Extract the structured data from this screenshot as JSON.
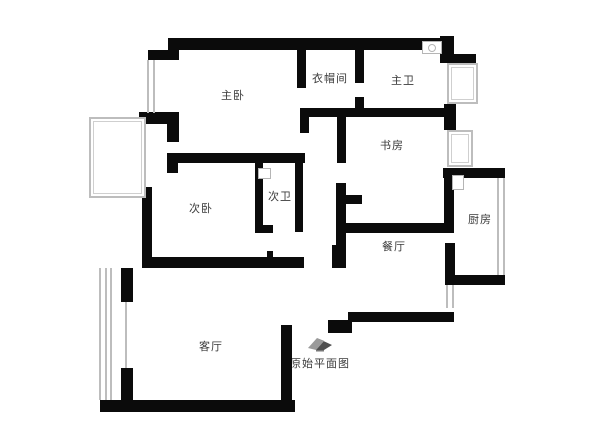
{
  "meta": {
    "caption": "原始平面图",
    "caption_icon": "house-roof-icon",
    "caption_x": 320,
    "caption_y": 336
  },
  "colors": {
    "wall": "#0b0b0b",
    "window": "#bdbdbd",
    "fixture": "#b5b5b5",
    "label": "#3a3a3a",
    "background": "#ffffff",
    "icon_dark": "#4f4f4f",
    "icon_light": "#9a9a9a"
  },
  "plan": {
    "rooms": [
      {
        "id": "master-bedroom",
        "label": "主卧",
        "x": 233,
        "y": 95
      },
      {
        "id": "closet",
        "label": "衣帽间",
        "x": 330,
        "y": 78
      },
      {
        "id": "master-bath",
        "label": "主卫",
        "x": 403,
        "y": 80
      },
      {
        "id": "study",
        "label": "书房",
        "x": 392,
        "y": 145
      },
      {
        "id": "second-bedroom",
        "label": "次卧",
        "x": 201,
        "y": 208
      },
      {
        "id": "second-bath",
        "label": "次卫",
        "x": 280,
        "y": 196
      },
      {
        "id": "dining-room",
        "label": "餐厅",
        "x": 394,
        "y": 246
      },
      {
        "id": "kitchen",
        "label": "厨房",
        "x": 480,
        "y": 219
      },
      {
        "id": "living-room",
        "label": "客厅",
        "x": 211,
        "y": 346
      }
    ],
    "walls": [
      [
        168,
        38,
        276,
        12
      ],
      [
        148,
        50,
        31,
        10
      ],
      [
        440,
        36,
        14,
        27
      ],
      [
        448,
        54,
        28,
        11
      ],
      [
        444,
        104,
        12,
        26
      ],
      [
        443,
        168,
        62,
        10
      ],
      [
        444,
        178,
        10,
        47
      ],
      [
        445,
        243,
        10,
        42
      ],
      [
        448,
        275,
        57,
        10
      ],
      [
        348,
        312,
        106,
        10
      ],
      [
        328,
        320,
        24,
        13
      ],
      [
        281,
        325,
        11,
        83
      ],
      [
        100,
        400,
        195,
        12
      ],
      [
        121,
        268,
        12,
        34
      ],
      [
        121,
        368,
        12,
        34
      ],
      [
        142,
        187,
        10,
        81
      ],
      [
        143,
        257,
        161,
        11
      ],
      [
        332,
        245,
        11,
        23
      ],
      [
        167,
        153,
        138,
        10
      ],
      [
        167,
        153,
        11,
        20
      ],
      [
        255,
        163,
        8,
        70
      ],
      [
        255,
        225,
        18,
        8
      ],
      [
        295,
        163,
        8,
        69
      ],
      [
        297,
        50,
        9,
        38
      ],
      [
        355,
        50,
        9,
        33
      ],
      [
        355,
        97,
        9,
        15
      ],
      [
        300,
        108,
        155,
        9
      ],
      [
        300,
        108,
        9,
        25
      ],
      [
        139,
        112,
        40,
        12
      ],
      [
        167,
        112,
        12,
        30
      ],
      [
        337,
        117,
        9,
        46
      ],
      [
        336,
        183,
        10,
        85
      ],
      [
        337,
        195,
        25,
        9
      ],
      [
        340,
        223,
        114,
        10
      ],
      [
        267,
        251,
        6,
        6
      ]
    ],
    "windows": [
      {
        "type": "vlines",
        "x": 147,
        "y": 60,
        "w": 8,
        "h": 53,
        "lines": 2
      },
      {
        "type": "box",
        "x": 89,
        "y": 117,
        "w": 57,
        "h": 81
      },
      {
        "type": "box",
        "x": 447,
        "y": 63,
        "w": 31,
        "h": 41
      },
      {
        "type": "box",
        "x": 447,
        "y": 130,
        "w": 26,
        "h": 37
      },
      {
        "type": "vlines",
        "x": 497,
        "y": 178,
        "w": 8,
        "h": 97,
        "lines": 2
      },
      {
        "type": "vlines",
        "x": 446,
        "y": 285,
        "w": 8,
        "h": 23,
        "lines": 2
      },
      {
        "type": "vlines",
        "x": 99,
        "y": 268,
        "w": 13,
        "h": 132,
        "lines": 3
      },
      {
        "type": "vlines",
        "x": 124,
        "y": 302,
        "w": 3,
        "h": 66,
        "lines": 1
      }
    ],
    "fixtures": [
      {
        "id": "master-bath-sink",
        "type": "sink",
        "x": 422,
        "y": 41,
        "w": 20,
        "h": 13
      },
      {
        "id": "second-bath-sink",
        "type": "rect",
        "x": 258,
        "y": 168,
        "w": 13,
        "h": 11
      },
      {
        "id": "kitchen-sink",
        "type": "rect",
        "x": 452,
        "y": 175,
        "w": 12,
        "h": 15
      }
    ]
  }
}
